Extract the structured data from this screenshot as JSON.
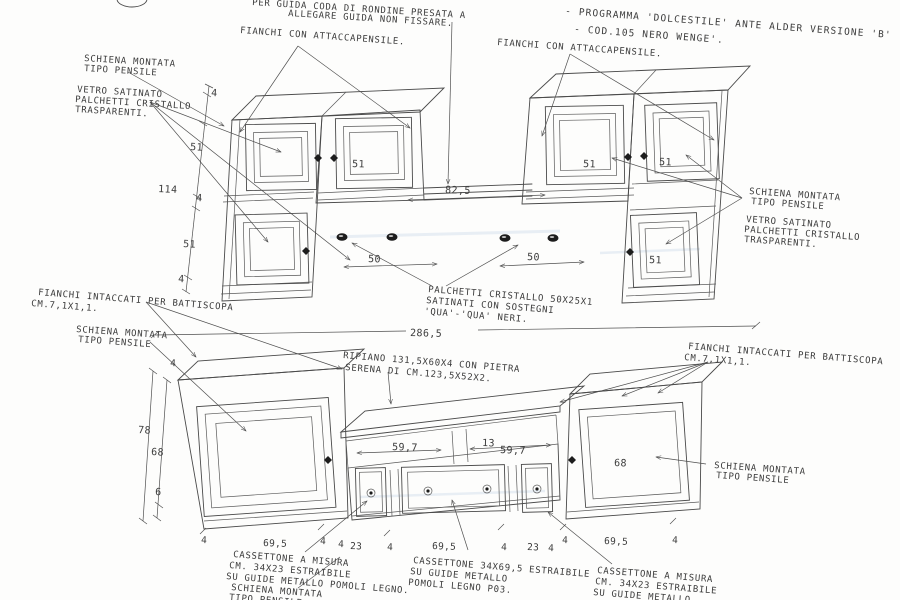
{
  "colors": {
    "line": "#4a4a4a",
    "text": "#3c3c3c",
    "glass_tint": "#bfcfdf",
    "stone_dot": "#777777"
  },
  "notes": {
    "top_note": {
      "line1": "PER GUIDA CODA DI RONDINE PRESATA A",
      "line2": "ALLEGARE GUIDA NON FISSARE."
    },
    "program": {
      "line1": "- PROGRAMMA 'DOLCESTILE' ANTE ALDER VERSIONE 'B'",
      "line2": "- COD.105 NERO WENGE'."
    },
    "fianchi_attaccapensile_left": "FIANCHI CON ATTACCAPENSILE.",
    "fianchi_attaccapensile_right": "FIANCHI CON ATTACCAPENSILE.",
    "schiena_upper_left": {
      "line1": "SCHIENA MONTATA",
      "line2": "TIPO PENSILE"
    },
    "vetro_upper_left": {
      "line1": "VETRO SATINATO",
      "line2": "PALCHETTI CRISTALLO",
      "line3": "TRASPARENTI."
    },
    "schiena_upper_right": {
      "line1": "SCHIENA MONTATA",
      "line2": "TIPO PENSILE"
    },
    "vetro_upper_right": {
      "line1": "VETRO SATINATO",
      "line2": "PALCHETTI CRISTALLO",
      "line3": "TRASPARENTI."
    },
    "palchetti_center": {
      "line1": "PALCHETTI CRISTALLO 50X25X1",
      "line2": "SATINATI CON SOSTEGNI",
      "line3": "'QUA'-'QUA' NERI."
    },
    "fianchi_battiscopa_left": {
      "line1": "FIANCHI INTACCATI PER BATTISCOPA",
      "line2": "CM.7,1X1,1."
    },
    "schiena_mid_left": {
      "line1": "SCHIENA MONTATA",
      "line2": "TIPO PENSILE"
    },
    "ripiano": {
      "line1": "RIPIANO 131,5X60X4 CON PIETRA",
      "line2": "SERENA DI CM.123,5X52X2."
    },
    "fianchi_battiscopa_right": {
      "line1": "FIANCHI INTACCATI PER BATTISCOPA",
      "line2": "CM.7,1X1,1."
    },
    "schiena_lower_right": {
      "line1": "SCHIENA MONTATA",
      "line2": "TIPO PENSILE"
    },
    "cassettone_left": {
      "line1": "CASSETTONE A MISURA",
      "line2": "CM. 34X23 ESTRAIBILE",
      "line3": "SU GUIDE METALLO POMOLI LEGNO."
    },
    "schiena_bottom_left": {
      "line1": "SCHIENA MONTATA",
      "line2": "TIPO PENSILE"
    },
    "cassettone_center": {
      "line1": "CASSETTONE 34X69,5 ESTRAIBILE",
      "line2": "SU GUIDE METALLO",
      "line3": "POMOLI LEGNO P03."
    },
    "cassettone_right": {
      "line1": "CASSETTONE A MISURA",
      "line2": "CM. 34X23 ESTRAIBILE",
      "line3": "SU GUIDE METALLO"
    }
  },
  "upper_view": {
    "dim_top_thickness": "4",
    "dim_door_upper": "51",
    "dim_total_height": "114",
    "dim_shelf": "4",
    "dim_door_lower": "51",
    "dim_bottom": "4",
    "door_labels": [
      "51",
      "51",
      "51",
      "51"
    ],
    "dim_bridge_width": "82,5",
    "dim_knob_left": "50",
    "dim_knob_right": "50"
  },
  "lower_view": {
    "dim_total_width": "286,5",
    "dim_side_top": "4",
    "dim_total_height": "78",
    "dim_door_height": "68",
    "dim_plinth": "6",
    "dim_shelf_left": "59,7",
    "dim_shelf_gap": "13",
    "dim_shelf_right": "59,7",
    "door_label": "68",
    "bottom_row": [
      "4",
      "69,5",
      "4",
      "4",
      "23",
      "4",
      "69,5",
      "4",
      "23",
      "4",
      "4",
      "69,5",
      "4"
    ]
  }
}
